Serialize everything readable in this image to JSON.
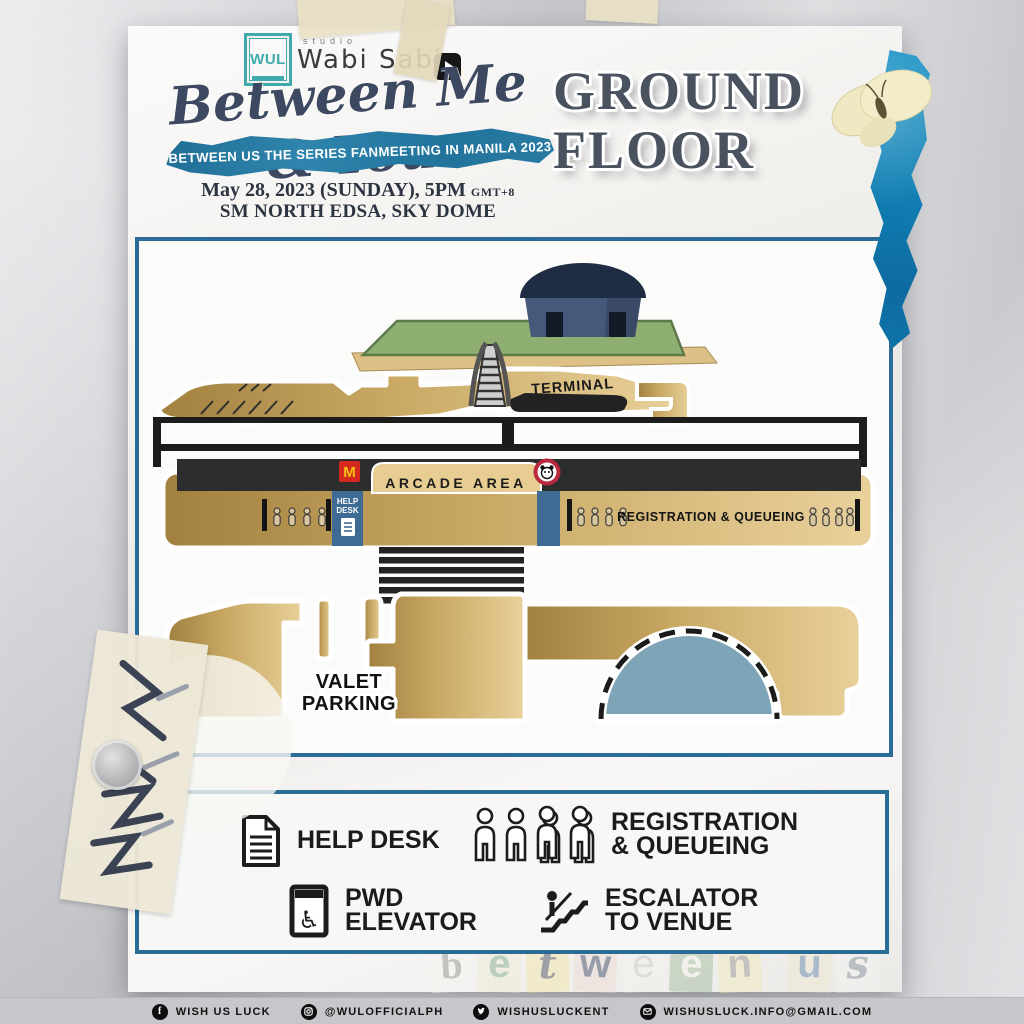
{
  "header": {
    "wul_logo_text": "WUL",
    "studio_label": "studio",
    "studio_name": "Wabi Sabi",
    "event_title": "Between Me & You",
    "banner_text": "BETWEEN US THE SERIES FANMEETING IN MANILA 2023",
    "date_text": "May 28, 2023 (SUNDAY), 5PM",
    "timezone_text": "GMT+8",
    "venue_text": "SM NORTH EDSA, SKY DOME",
    "floor_line1": "GROUND",
    "floor_line2": "FLOOR"
  },
  "map": {
    "terminal_label": "TERMINAL",
    "arcade_area_label": "ARCADE AREA",
    "mcdonalds_monogram": "M",
    "help_desk_box_line1": "HELP",
    "help_desk_box_line2": "DESK",
    "registration_queueing_label": "REGISTRATION & QUEUEING",
    "valet_line1": "VALET",
    "valet_line2": "PARKING"
  },
  "legend": {
    "help_desk": "HELP DESK",
    "registration_line1": "REGISTRATION",
    "registration_line2": "& QUEUEING",
    "pwd_line1": "PWD",
    "pwd_line2": "ELEVATOR",
    "escalator_line1": "ESCALATOR",
    "escalator_line2": "TO VENUE"
  },
  "watermark": {
    "letters": [
      "b",
      "e",
      "t",
      "w",
      "e",
      "e",
      "n",
      "u",
      "s"
    ]
  },
  "footer": {
    "facebook_label": "WISH US LUCK",
    "instagram_label": "@WULOFFICIALPH",
    "twitter_label": "WISHUSLUCKENT",
    "email_label": "WISHUSLUCK.INFO@GMAIL.COM",
    "facebook_glyph": "f"
  },
  "colors": {
    "panel_border_blue": "#2b6b97",
    "banner_blue": "#2a7ba3",
    "gold_light": "#e9d19b",
    "gold_dark": "#a2813f",
    "dome_footprint_blue": "#7ea4b7",
    "help_desk_blue": "#3e6b94",
    "mcdonalds_red": "#d5281e",
    "mcdonalds_yellow": "#f7c210",
    "wul_teal": "#3fa9ab",
    "title_slate": "#3c4961"
  }
}
